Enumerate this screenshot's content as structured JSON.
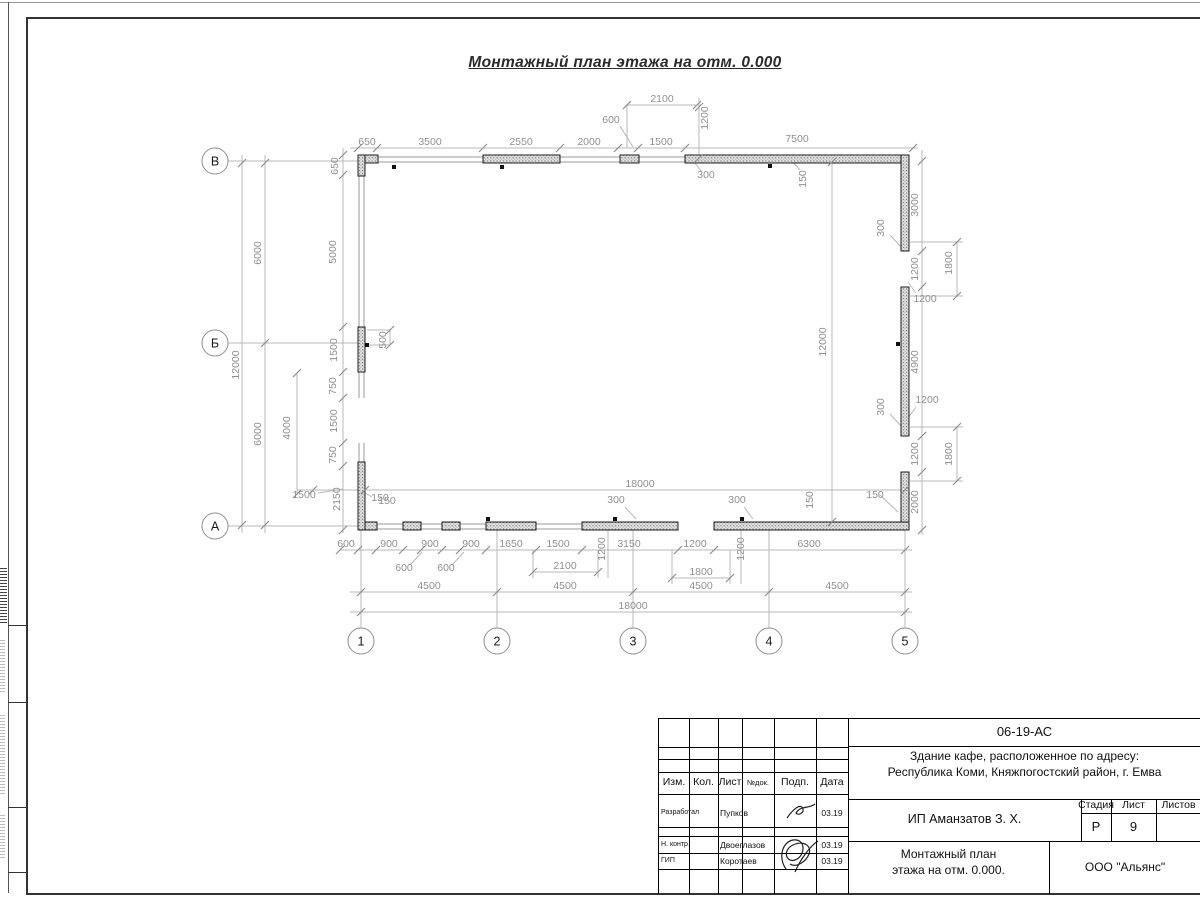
{
  "page": {
    "drawing_title": "Монтажный план этажа на отм. 0.000"
  },
  "plan": {
    "axes_left": [
      [
        "В",
        215,
        161
      ],
      [
        "Б",
        215,
        343
      ],
      [
        "А",
        215,
        526
      ]
    ],
    "axes_bottom": [
      [
        "1",
        361,
        641
      ],
      [
        "2",
        497,
        641
      ],
      [
        "3",
        633,
        641
      ],
      [
        "4",
        769,
        641
      ],
      [
        "5",
        905,
        641
      ]
    ],
    "walls": [
      [
        358,
        155,
        20,
        8
      ],
      [
        358,
        155,
        7,
        21
      ],
      [
        483,
        155,
        77,
        8
      ],
      [
        620,
        155,
        19,
        8
      ],
      [
        685,
        155,
        224,
        8
      ],
      [
        901,
        155,
        8,
        96
      ],
      [
        901,
        287,
        8,
        149
      ],
      [
        901,
        472,
        8,
        58
      ],
      [
        358,
        522,
        19,
        8
      ],
      [
        358,
        462,
        7,
        68
      ],
      [
        403,
        522,
        18,
        8
      ],
      [
        442,
        522,
        18,
        8
      ],
      [
        486,
        522,
        50,
        8
      ],
      [
        582,
        522,
        96,
        8
      ],
      [
        714,
        522,
        195,
        8
      ],
      [
        358,
        327,
        7,
        45
      ]
    ],
    "wall_lines": [
      [
        358,
        157,
        909,
        157
      ],
      [
        358,
        162,
        909,
        162
      ],
      [
        358,
        524,
        678,
        524
      ],
      [
        358,
        529,
        678,
        529
      ],
      [
        714,
        524,
        909,
        524
      ],
      [
        714,
        529,
        909,
        529
      ],
      [
        359,
        155,
        359,
        398
      ],
      [
        364,
        155,
        364,
        398
      ],
      [
        359,
        443,
        359,
        530
      ],
      [
        364,
        443,
        364,
        530
      ],
      [
        902,
        155,
        902,
        251
      ],
      [
        908,
        155,
        908,
        251
      ],
      [
        902,
        287,
        902,
        436
      ],
      [
        908,
        287,
        908,
        436
      ],
      [
        902,
        472,
        902,
        530
      ],
      [
        908,
        472,
        908,
        530
      ]
    ],
    "dim_lines": [
      [
        350,
        148,
        918,
        148
      ],
      [
        627,
        105,
        697,
        105
      ],
      [
        627,
        105,
        627,
        148
      ],
      [
        699,
        98,
        699,
        162
      ],
      [
        340,
        550,
        912,
        550
      ],
      [
        533,
        550,
        533,
        578
      ],
      [
        598,
        550,
        598,
        578
      ],
      [
        533,
        572,
        598,
        572
      ],
      [
        672,
        550,
        672,
        584
      ],
      [
        730,
        550,
        730,
        584
      ],
      [
        672,
        578,
        730,
        578
      ],
      [
        350,
        592,
        912,
        592
      ],
      [
        350,
        612,
        912,
        612
      ],
      [
        297,
        490,
        905,
        490
      ],
      [
        832,
        162,
        832,
        522
      ],
      [
        242,
        155,
        242,
        533
      ],
      [
        265,
        155,
        265,
        533
      ],
      [
        297,
        373,
        297,
        494
      ],
      [
        343,
        148,
        343,
        533
      ],
      [
        922,
        150,
        922,
        535
      ],
      [
        957,
        242,
        957,
        296
      ],
      [
        957,
        427,
        957,
        481
      ],
      [
        910,
        242,
        963,
        242
      ],
      [
        910,
        296,
        963,
        296
      ],
      [
        910,
        427,
        963,
        427
      ],
      [
        910,
        481,
        963,
        481
      ],
      [
        228,
        161,
        358,
        161
      ],
      [
        228,
        343,
        358,
        343
      ],
      [
        228,
        526,
        358,
        526
      ],
      [
        361,
        530,
        361,
        628
      ],
      [
        497,
        530,
        497,
        628
      ],
      [
        633,
        530,
        633,
        628
      ],
      [
        769,
        530,
        769,
        628
      ],
      [
        905,
        530,
        905,
        628
      ],
      [
        608,
        530,
        608,
        578
      ],
      [
        741,
        530,
        741,
        584
      ],
      [
        390,
        330,
        390,
        345
      ],
      [
        367,
        330,
        390,
        330
      ],
      [
        367,
        345,
        390,
        345
      ],
      [
        620,
        126,
        633,
        147
      ],
      [
        690,
        157,
        702,
        172
      ],
      [
        410,
        565,
        422,
        552
      ],
      [
        452,
        565,
        464,
        552
      ],
      [
        318,
        493,
        343,
        489
      ],
      [
        372,
        497,
        362,
        491
      ],
      [
        625,
        507,
        636,
        519
      ],
      [
        744,
        507,
        753,
        519
      ],
      [
        880,
        495,
        898,
        512
      ],
      [
        800,
        170,
        789,
        158
      ],
      [
        890,
        235,
        901,
        247
      ],
      [
        890,
        414,
        901,
        426
      ],
      [
        916,
        293,
        908,
        282
      ],
      [
        916,
        407,
        908,
        418
      ]
    ],
    "ticks": [
      [
        358,
        148
      ],
      [
        377,
        148
      ],
      [
        483,
        148
      ],
      [
        560,
        148
      ],
      [
        618,
        148
      ],
      [
        638,
        148
      ],
      [
        685,
        148
      ],
      [
        913,
        148
      ],
      [
        627,
        105
      ],
      [
        697,
        105
      ],
      [
        699,
        107
      ],
      [
        699,
        158
      ],
      [
        340,
        550
      ],
      [
        358,
        550
      ],
      [
        376,
        550
      ],
      [
        403,
        550
      ],
      [
        421,
        550
      ],
      [
        442,
        550
      ],
      [
        460,
        550
      ],
      [
        486,
        550
      ],
      [
        536,
        550
      ],
      [
        582,
        550
      ],
      [
        678,
        550
      ],
      [
        714,
        550
      ],
      [
        905,
        550
      ],
      [
        533,
        572
      ],
      [
        598,
        572
      ],
      [
        672,
        578
      ],
      [
        730,
        578
      ],
      [
        361,
        592
      ],
      [
        497,
        592
      ],
      [
        633,
        592
      ],
      [
        769,
        592
      ],
      [
        905,
        592
      ],
      [
        361,
        612
      ],
      [
        905,
        612
      ],
      [
        313,
        490
      ],
      [
        365,
        490
      ],
      [
        905,
        490
      ],
      [
        242,
        163
      ],
      [
        242,
        525
      ],
      [
        265,
        163
      ],
      [
        265,
        343
      ],
      [
        265,
        525
      ],
      [
        297,
        373
      ],
      [
        297,
        494
      ],
      [
        343,
        155
      ],
      [
        343,
        175
      ],
      [
        343,
        327
      ],
      [
        343,
        372
      ],
      [
        343,
        398
      ],
      [
        343,
        443
      ],
      [
        343,
        466
      ],
      [
        343,
        530
      ],
      [
        832,
        162
      ],
      [
        832,
        522
      ],
      [
        922,
        161
      ],
      [
        922,
        251
      ],
      [
        922,
        287
      ],
      [
        922,
        436
      ],
      [
        922,
        472
      ],
      [
        922,
        530
      ],
      [
        957,
        242
      ],
      [
        957,
        296
      ],
      [
        957,
        427
      ],
      [
        957,
        481
      ],
      [
        390,
        330
      ],
      [
        390,
        345
      ]
    ],
    "anchors": [
      [
        394,
        167
      ],
      [
        502,
        167
      ],
      [
        770,
        166
      ],
      [
        488,
        519
      ],
      [
        615,
        519
      ],
      [
        742,
        519
      ],
      [
        898,
        344
      ],
      [
        367,
        345
      ]
    ],
    "labels": [
      [
        "650",
        367,
        145,
        0
      ],
      [
        "3500",
        430,
        145,
        0
      ],
      [
        "2550",
        521,
        145,
        0
      ],
      [
        "2000",
        589,
        145,
        0
      ],
      [
        "1500",
        661,
        145,
        0
      ],
      [
        "7500",
        797,
        142,
        0
      ],
      [
        "2100",
        662,
        102,
        0
      ],
      [
        "600",
        611,
        123,
        0
      ],
      [
        "1200",
        708,
        118,
        1
      ],
      [
        "300",
        706,
        178,
        0
      ],
      [
        "150",
        806,
        179,
        1
      ],
      [
        "3000",
        918,
        205,
        1
      ],
      [
        "300",
        884,
        228,
        1
      ],
      [
        "1200",
        918,
        269,
        1
      ],
      [
        "1800",
        952,
        263,
        1
      ],
      [
        "1200",
        925,
        302,
        0
      ],
      [
        "4900",
        918,
        362,
        1
      ],
      [
        "300",
        884,
        407,
        1
      ],
      [
        "1200",
        918,
        454,
        1
      ],
      [
        "1800",
        952,
        454,
        1
      ],
      [
        "1200",
        927,
        403,
        0
      ],
      [
        "2000",
        918,
        502,
        1
      ],
      [
        "150",
        875,
        498,
        0
      ],
      [
        "600",
        346,
        547,
        0
      ],
      [
        "900",
        389,
        547,
        0
      ],
      [
        "900",
        430,
        547,
        0
      ],
      [
        "900",
        471,
        547,
        0
      ],
      [
        "1650",
        511,
        547,
        0
      ],
      [
        "1500",
        558,
        547,
        0
      ],
      [
        "3150",
        629,
        547,
        0
      ],
      [
        "1200",
        695,
        547,
        0
      ],
      [
        "6300",
        809,
        547,
        0
      ],
      [
        "1200",
        605,
        549,
        1
      ],
      [
        "1200",
        744,
        549,
        1
      ],
      [
        "600",
        404,
        571,
        0
      ],
      [
        "600",
        446,
        571,
        0
      ],
      [
        "2100",
        565,
        569,
        0
      ],
      [
        "1800",
        701,
        575,
        0
      ],
      [
        "300",
        616,
        503,
        0
      ],
      [
        "300",
        737,
        503,
        0
      ],
      [
        "150",
        387,
        504,
        0
      ],
      [
        "150",
        813,
        500,
        1
      ],
      [
        "4500",
        429,
        589,
        0
      ],
      [
        "4500",
        565,
        589,
        0
      ],
      [
        "4500",
        701,
        589,
        0
      ],
      [
        "4500",
        837,
        589,
        0
      ],
      [
        "18000",
        633,
        609,
        0
      ],
      [
        "18000",
        640,
        487,
        0
      ],
      [
        "12000",
        826,
        342,
        1
      ],
      [
        "650",
        338,
        166,
        1
      ],
      [
        "5000",
        336,
        252,
        1
      ],
      [
        "1500",
        337,
        350,
        1
      ],
      [
        "750",
        336,
        386,
        1
      ],
      [
        "1500",
        337,
        421,
        1
      ],
      [
        "750",
        336,
        455,
        1
      ],
      [
        "2150",
        340,
        499,
        1
      ],
      [
        "6000",
        261,
        253,
        1
      ],
      [
        "6000",
        261,
        434,
        1
      ],
      [
        "12000",
        239,
        365,
        1
      ],
      [
        "4000",
        290,
        428,
        1
      ],
      [
        "500",
        386,
        340,
        1
      ],
      [
        "1500",
        304,
        498,
        0
      ],
      [
        "150",
        380,
        501,
        0
      ]
    ]
  },
  "title_block": {
    "doc_number": "06-19-АС",
    "project_line1": "Здание кафе, расположенное по адресу:",
    "project_line2": "Республика Коми, Княжпогостский район, г. Емва",
    "client": "ИП Аманзатов З. Х.",
    "sheet_title_line1": "Монтажный план",
    "sheet_title_line2": "этажа на отм. 0.000.",
    "organization": "ООО \"Альянс\"",
    "stage_label": "Стадия",
    "sheet_label": "Лист",
    "sheets_label": "Листов",
    "stage_value": "Р",
    "sheet_value": "9",
    "header_cols": [
      "Изм.",
      "Кол.",
      "Лист",
      "№док.",
      "Подп.",
      "Дата"
    ],
    "rows": [
      {
        "role": "Разработал",
        "name": "Пупков",
        "date": "03.19"
      },
      {
        "role": "Н. контр.",
        "name": "Двоеглазов",
        "date": "03.19"
      },
      {
        "role": "ГИП",
        "name": "Коротаев",
        "date": "03.19"
      }
    ]
  }
}
